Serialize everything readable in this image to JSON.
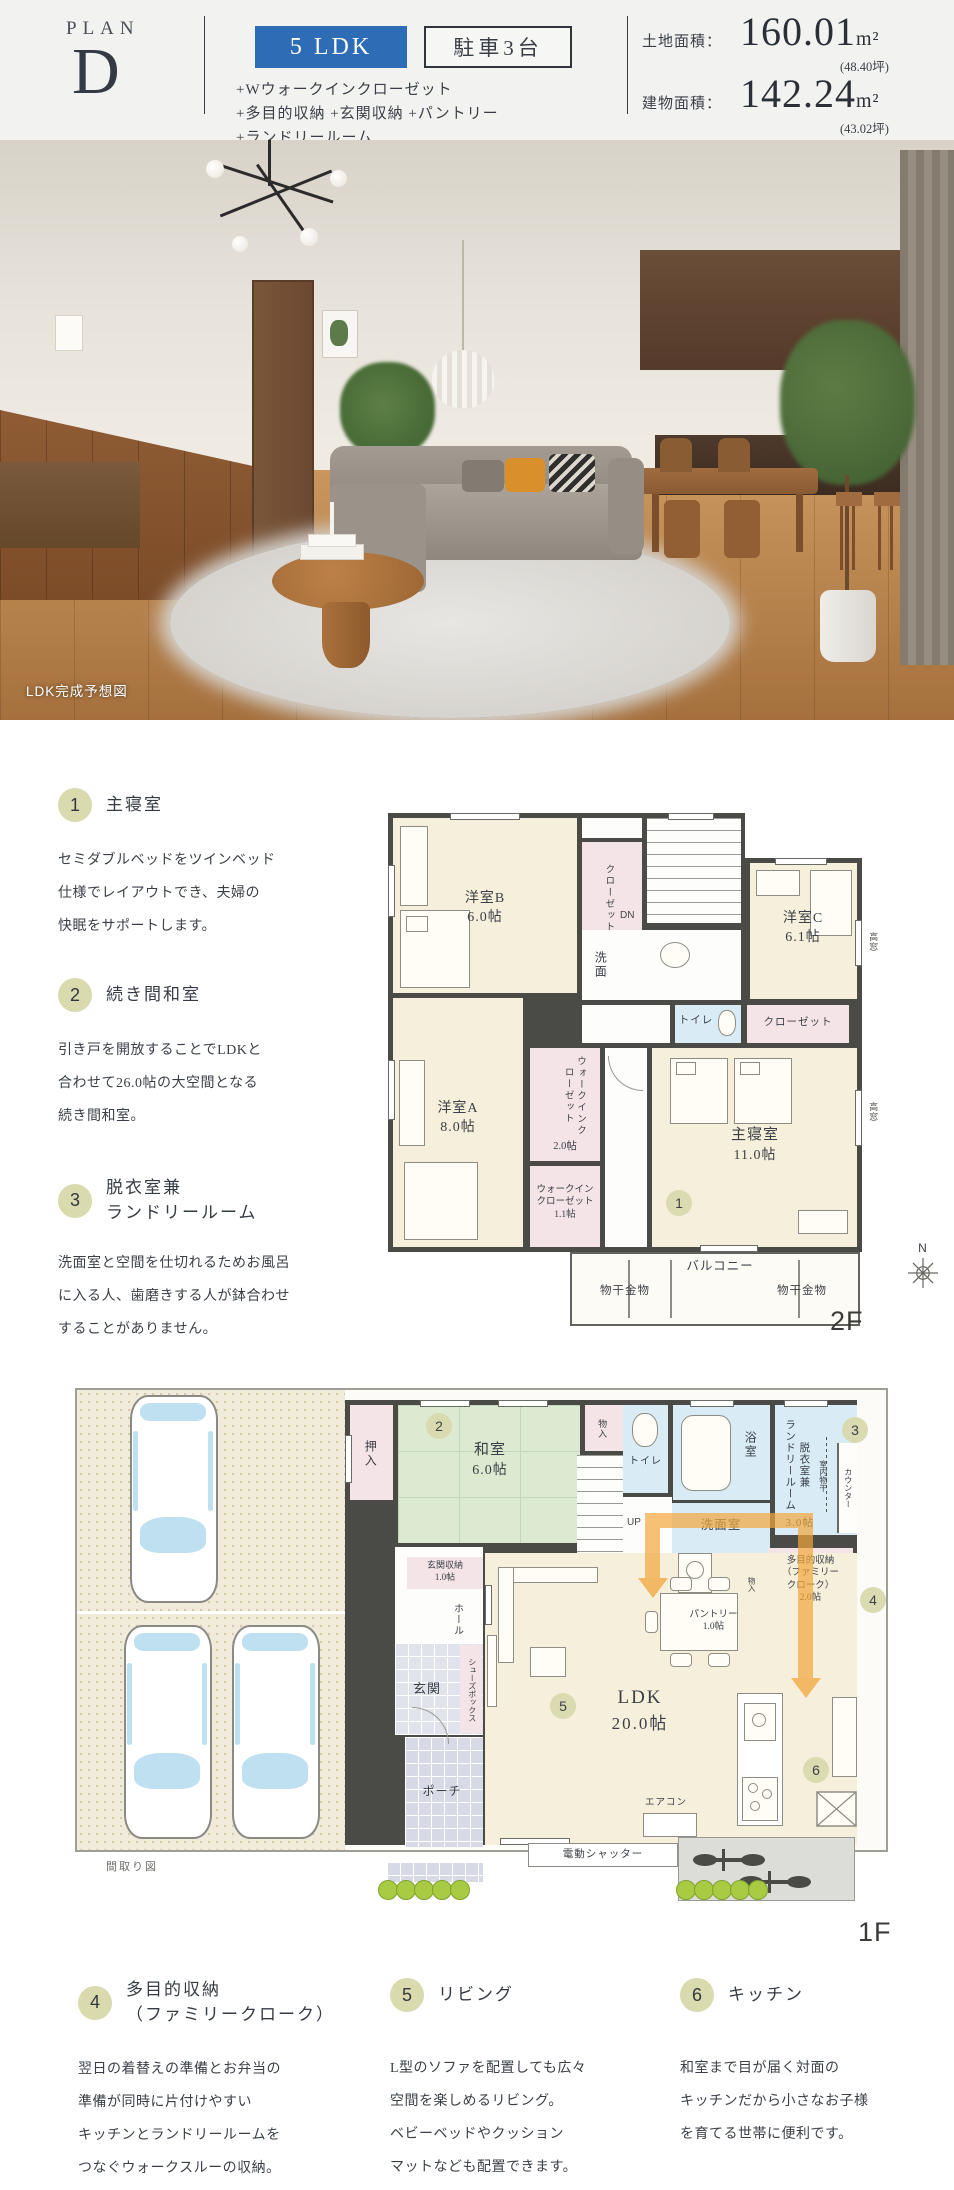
{
  "colors": {
    "accent_blue": "#2e6cb5",
    "marker_olive": "#d9daae",
    "plan_beige": "#f6efdb",
    "tatami_green": "#dcead2",
    "closet_pink": "#f4e3e7",
    "wet_blue": "#d9ecf6",
    "wall_gray": "#4a4a46"
  },
  "header": {
    "plan_label": "PLAN",
    "plan_letter": "D",
    "type_badge": "5 LDK",
    "parking_badge": "駐車3台",
    "features": [
      "+Wウォークインクローゼット",
      "+多目的収納 +玄関収納 +パントリー",
      "+ランドリールーム"
    ],
    "land_label": "土地面積：",
    "land_value": "160.01",
    "land_unit": "m²",
    "land_tsubo": "(48.40坪)",
    "building_label": "建物面積：",
    "building_value": "142.24",
    "building_unit": "m²",
    "building_tsubo": "(43.02坪)"
  },
  "photo": {
    "caption": "LDK完成予想図"
  },
  "sections": [
    {
      "num": "1",
      "title": "主寝室",
      "body": "セミダブルベッドをツインベッド\n仕様でレイアウトでき、夫婦の\n快眠をサポートします。"
    },
    {
      "num": "2",
      "title": "続き間和室",
      "body": "引き戸を開放することでLDKと\n合わせて26.0帖の大空間となる\n続き間和室。"
    },
    {
      "num": "3",
      "title": "脱衣室兼\nランドリールーム",
      "body": "洗面室と空間を仕切れるためお風呂\nに入る人、歯磨きする人が鉢合わせ\nすることがありません。"
    },
    {
      "num": "4",
      "title": "多目的収納\n（ファミリークローク）",
      "body": "翌日の着替えの準備とお弁当の\n準備が同時に片付けやすい\nキッチンとランドリールームを\nつなぐウォークスルーの収納。"
    },
    {
      "num": "5",
      "title": "リビング",
      "body": "L型のソファを配置しても広々\n空間を楽しめるリビング。\nベビーベッドやクッション\nマットなども配置できます。"
    },
    {
      "num": "6",
      "title": "キッチン",
      "body": "和室まで目が届く対面の\nキッチンだから小さなお子様\nを育てる世帯に便利です。"
    }
  ],
  "plan2f": {
    "floor_label": "2F",
    "compass": "N",
    "yoshitsu_b_name": "洋室B",
    "yoshitsu_b_size": "6.0帖",
    "yoshitsu_c_name": "洋室C",
    "yoshitsu_c_size": "6.1帖",
    "yoshitsu_a_name": "洋室A",
    "yoshitsu_a_size": "8.0帖",
    "master_name": "主寝室",
    "master_size": "11.0帖",
    "closet_strip": "クローゼット",
    "closet_master": "クローゼット",
    "wic2_name": "ウォークインクローゼット",
    "wic2_size": "2.0帖",
    "wic1": "ウォークイン\nクローゼット\n1.1帖",
    "senmen": "洗面",
    "toilet": "トイレ",
    "dn": "DN",
    "balcony": "バルコニー",
    "monohoshi_left": "物干金物",
    "monohoshi_right": "物干金物",
    "takamado_1": "高窓",
    "takamado_2": "高窓"
  },
  "plan1f": {
    "floor_label": "1F",
    "caption": "間取り図",
    "oshiire": "押入",
    "washitsu_name": "和室",
    "washitsu_size": "6.0帖",
    "monoire_top": "物入",
    "up": "UP",
    "genkan_shuno": "玄関収納\n1.0帖",
    "hall": "ホール",
    "genkan": "玄関",
    "shoes_box": "シューズボックス",
    "porch": "ポーチ",
    "toilet": "トイレ",
    "bath": "浴室",
    "datsui": "脱衣室兼\nランドリールーム",
    "datsui_size": "3.0帖",
    "monohoshi_indoor": "室内物干",
    "counter": "カウンター",
    "senmenshitsu": "洗面室",
    "monoire_small": "物入",
    "tamokuteki": "多目的収納\n（ファミリー\nクローク）\n2.0帖",
    "pantry": "パントリー\n1.0帖",
    "ldk_name": "LDK",
    "ldk_size": "20.0帖",
    "aircon": "エアコン",
    "shutter": "電動シャッター"
  }
}
